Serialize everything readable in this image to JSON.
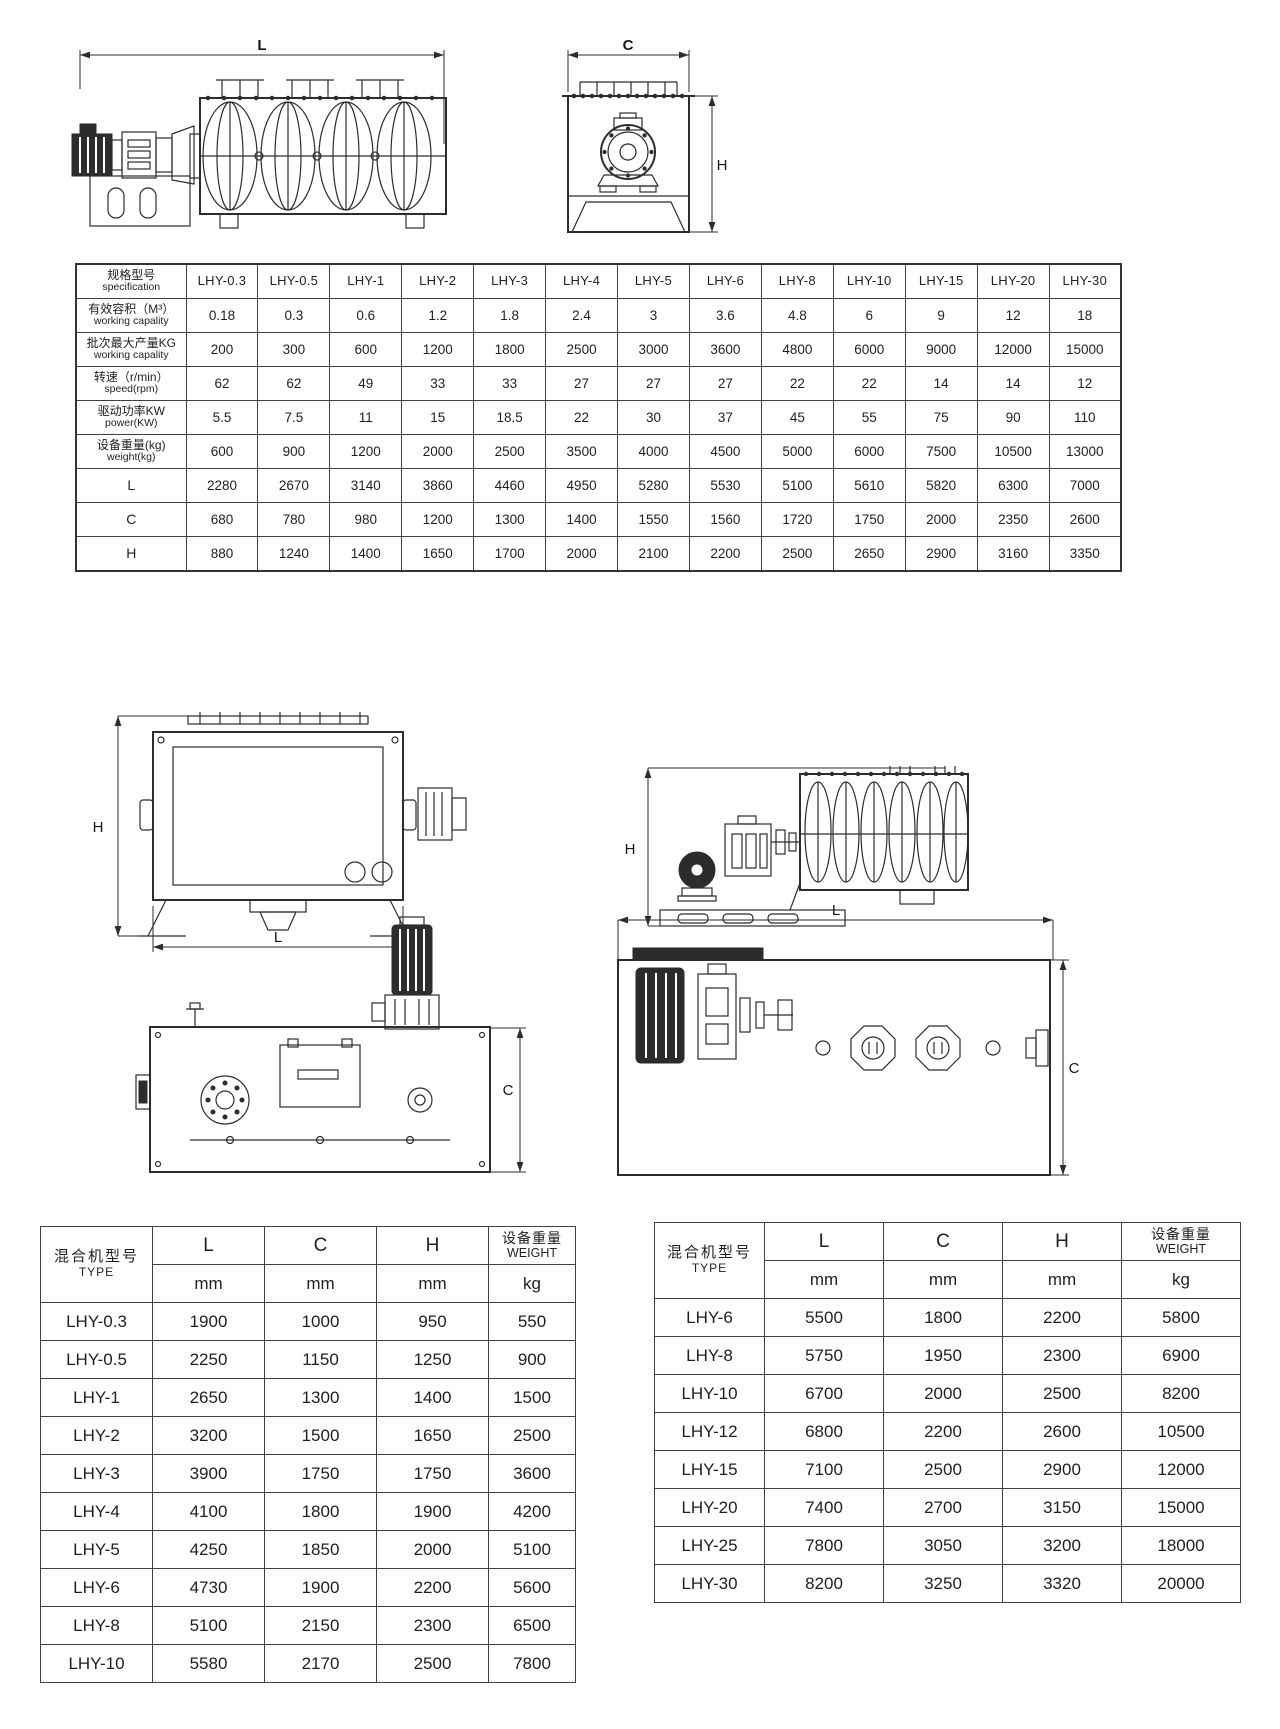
{
  "page": {
    "background": "#ffffff",
    "line_color": "#2c2c2c",
    "text_color": "#1f1f1f"
  },
  "dim_labels": {
    "top_side_L": "L",
    "top_end_C": "C",
    "top_end_H": "H",
    "front_H": "H",
    "front_L": "L",
    "side2_H": "H",
    "plan_left_C": "C",
    "plan_right_L": "L",
    "plan_right_C": "C"
  },
  "spec_table": {
    "header": {
      "zh": "规格型号",
      "en": "specification"
    },
    "models": [
      "LHY-0.3",
      "LHY-0.5",
      "LHY-1",
      "LHY-2",
      "LHY-3",
      "LHY-4",
      "LHY-5",
      "LHY-6",
      "LHY-8",
      "LHY-10",
      "LHY-15",
      "LHY-20",
      "LHY-30"
    ],
    "rows": [
      {
        "zh": "有效容积（M³）",
        "en": "working capality",
        "values": [
          "0.18",
          "0.3",
          "0.6",
          "1.2",
          "1.8",
          "2.4",
          "3",
          "3.6",
          "4.8",
          "6",
          "9",
          "12",
          "18"
        ]
      },
      {
        "zh": "批次最大产量KG",
        "en": "working capality",
        "values": [
          "200",
          "300",
          "600",
          "1200",
          "1800",
          "2500",
          "3000",
          "3600",
          "4800",
          "6000",
          "9000",
          "12000",
          "15000"
        ]
      },
      {
        "zh": "转速（r/min）",
        "en": "speed(rpm)",
        "values": [
          "62",
          "62",
          "49",
          "33",
          "33",
          "27",
          "27",
          "27",
          "22",
          "22",
          "14",
          "14",
          "12"
        ]
      },
      {
        "zh": "驱动功率KW",
        "en": "power(KW)",
        "values": [
          "5.5",
          "7.5",
          "11",
          "15",
          "18.5",
          "22",
          "30",
          "37",
          "45",
          "55",
          "75",
          "90",
          "110"
        ]
      },
      {
        "zh": "设备重量(kg)",
        "en": "weight(kg)",
        "values": [
          "600",
          "900",
          "1200",
          "2000",
          "2500",
          "3500",
          "4000",
          "4500",
          "5000",
          "6000",
          "7500",
          "10500",
          "13000"
        ]
      },
      {
        "zh": "L",
        "en": "",
        "values": [
          "2280",
          "2670",
          "3140",
          "3860",
          "4460",
          "4950",
          "5280",
          "5530",
          "5100",
          "5610",
          "5820",
          "6300",
          "7000"
        ]
      },
      {
        "zh": "C",
        "en": "",
        "values": [
          "680",
          "780",
          "980",
          "1200",
          "1300",
          "1400",
          "1550",
          "1560",
          "1720",
          "1750",
          "2000",
          "2350",
          "2600"
        ]
      },
      {
        "zh": "H",
        "en": "",
        "values": [
          "880",
          "1240",
          "1400",
          "1650",
          "1700",
          "2000",
          "2100",
          "2200",
          "2500",
          "2650",
          "2900",
          "3160",
          "3350"
        ]
      }
    ]
  },
  "dim_table_left": {
    "header": {
      "type_zh": "混合机型号",
      "type_en": "TYPE",
      "l": "L",
      "c": "C",
      "h": "H",
      "weight_zh": "设备重量",
      "weight_en": "WEIGHT"
    },
    "units": [
      "mm",
      "mm",
      "mm",
      "kg"
    ],
    "rows": [
      [
        "LHY-0.3",
        "1900",
        "1000",
        "950",
        "550"
      ],
      [
        "LHY-0.5",
        "2250",
        "1150",
        "1250",
        "900"
      ],
      [
        "LHY-1",
        "2650",
        "1300",
        "1400",
        "1500"
      ],
      [
        "LHY-2",
        "3200",
        "1500",
        "1650",
        "2500"
      ],
      [
        "LHY-3",
        "3900",
        "1750",
        "1750",
        "3600"
      ],
      [
        "LHY-4",
        "4100",
        "1800",
        "1900",
        "4200"
      ],
      [
        "LHY-5",
        "4250",
        "1850",
        "2000",
        "5100"
      ],
      [
        "LHY-6",
        "4730",
        "1900",
        "2200",
        "5600"
      ],
      [
        "LHY-8",
        "5100",
        "2150",
        "2300",
        "6500"
      ],
      [
        "LHY-10",
        "5580",
        "2170",
        "2500",
        "7800"
      ]
    ]
  },
  "dim_table_right": {
    "header": {
      "type_zh": "混合机型号",
      "type_en": "TYPE",
      "l": "L",
      "c": "C",
      "h": "H",
      "weight_zh": "设备重量",
      "weight_en": "WEIGHT"
    },
    "units": [
      "mm",
      "mm",
      "mm",
      "kg"
    ],
    "rows": [
      [
        "LHY-6",
        "5500",
        "1800",
        "2200",
        "5800"
      ],
      [
        "LHY-8",
        "5750",
        "1950",
        "2300",
        "6900"
      ],
      [
        "LHY-10",
        "6700",
        "2000",
        "2500",
        "8200"
      ],
      [
        "LHY-12",
        "6800",
        "2200",
        "2600",
        "10500"
      ],
      [
        "LHY-15",
        "7100",
        "2500",
        "2900",
        "12000"
      ],
      [
        "LHY-20",
        "7400",
        "2700",
        "3150",
        "15000"
      ],
      [
        "LHY-25",
        "7800",
        "3050",
        "3200",
        "18000"
      ],
      [
        "LHY-30",
        "8200",
        "3250",
        "3320",
        "20000"
      ]
    ]
  }
}
